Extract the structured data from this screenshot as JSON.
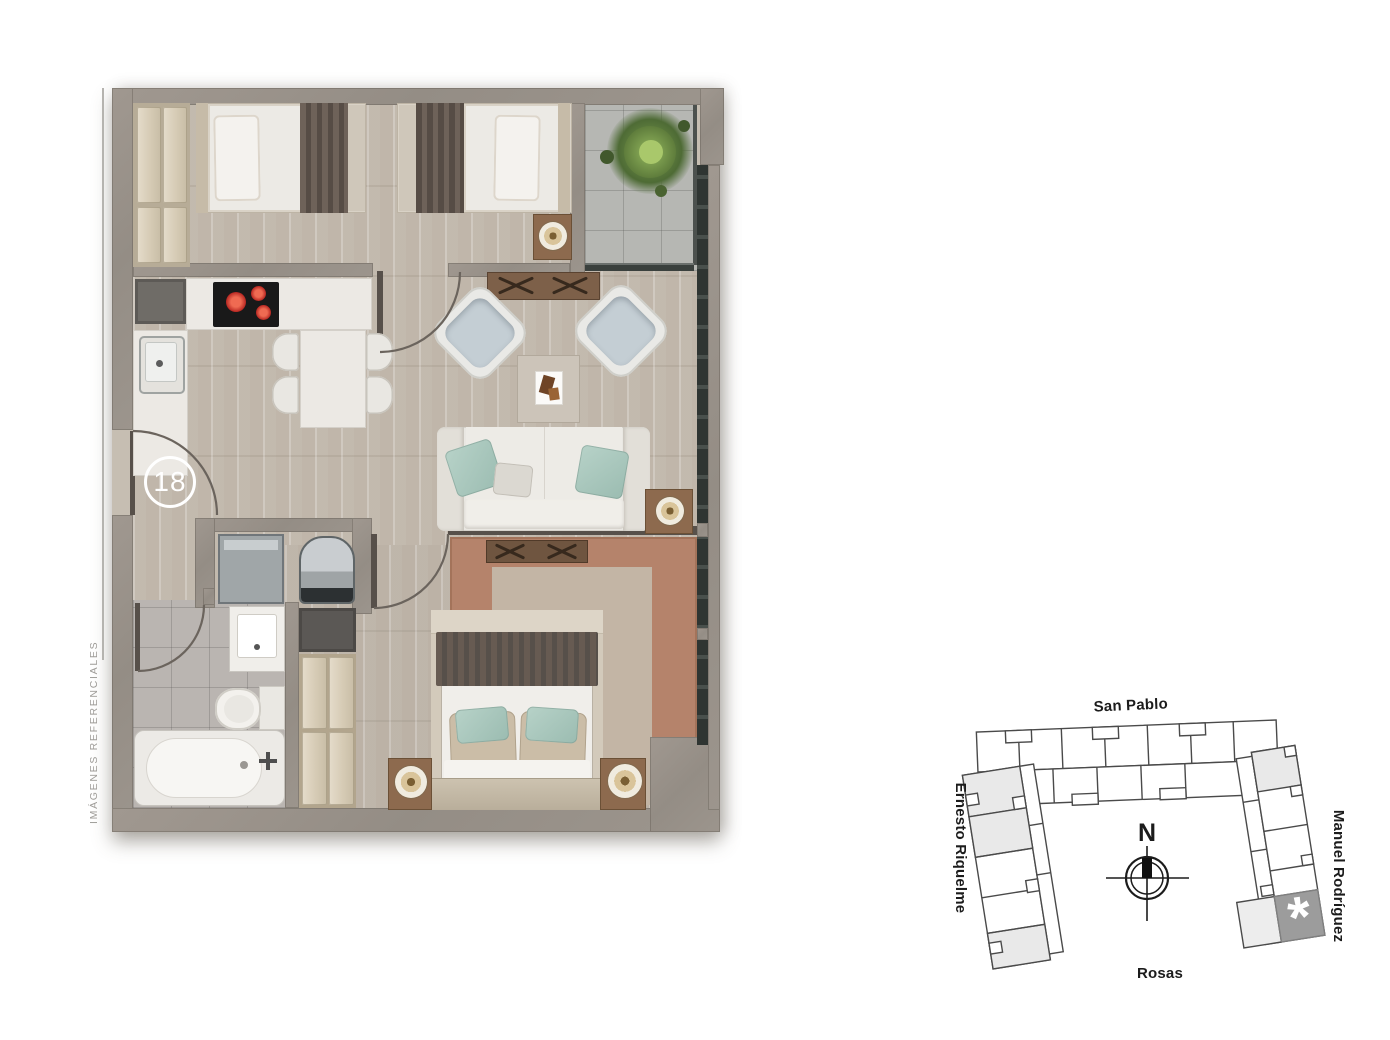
{
  "floor_plan": {
    "unit_badge": "18",
    "watermark": "IMÁGENES REFERENCIALES",
    "colors": {
      "wall": "#99928b",
      "wood_floor": "#ccc4b8",
      "balcony_tile": "#b6b7b3",
      "bathroom_tile": "#bab5b1",
      "counter_white": "#ece9e4",
      "stove_burner_red": "#c41e1e",
      "accent_teal": "#a9c8be",
      "rug_brown": "#b5836b",
      "throw_brown": "#5f544c",
      "closet_beige": "#ddd3c1",
      "badge_white": "#ffffff"
    }
  },
  "site_map": {
    "streets": {
      "top": "San Pablo",
      "left": "Ernesto Riquelme",
      "right": "Manuel Rodríguez",
      "bottom": "Rosas"
    },
    "compass": "N",
    "selected_unit_marker": "*",
    "colors": {
      "outline": "#4a4a4a",
      "shaded_unit": "#e9e9e9",
      "highlight_unit": "#9c9c9c",
      "marker_white": "#ffffff"
    }
  }
}
